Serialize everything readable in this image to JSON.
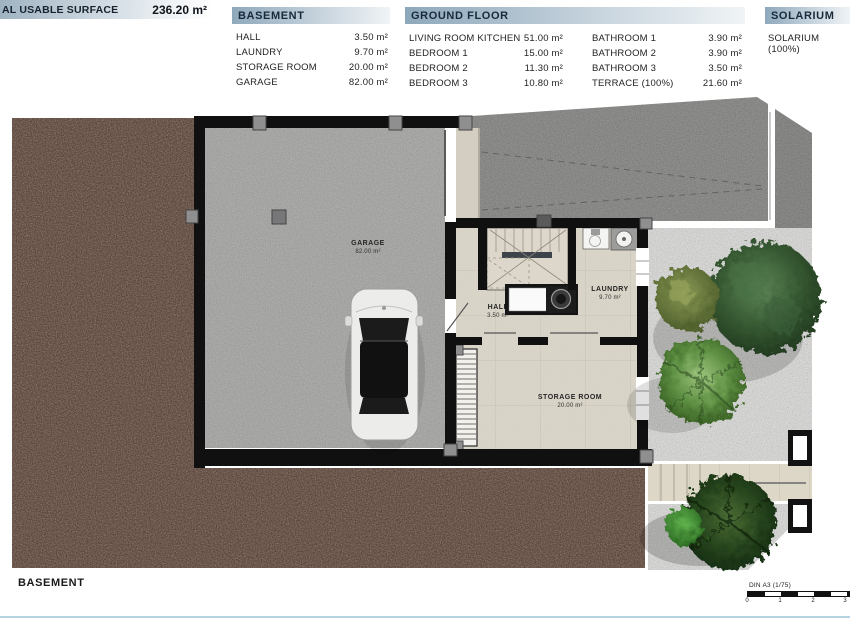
{
  "header": {
    "summary": {
      "title": "PE VILLA",
      "plot": {
        "label": "PLOT:",
        "value": "350.00 m²"
      },
      "built": {
        "label": "LT SURFACE",
        "sub": "(Terrace 100%)",
        "value": "249.90 m²"
      },
      "usable": {
        "label": "AL USABLE SURFACE",
        "value": "236.20 m²"
      }
    },
    "basement": {
      "title": "BASEMENT",
      "rows": [
        {
          "label": "HALL",
          "value": "3.50 m²"
        },
        {
          "label": "LAUNDRY",
          "value": "9.70 m²"
        },
        {
          "label": "STORAGE ROOM",
          "value": "20.00 m²"
        },
        {
          "label": "GARAGE",
          "value": "82.00 m²"
        }
      ]
    },
    "ground_floor": {
      "title": "GROUND FLOOR",
      "rows_left": [
        {
          "label": "LIVING ROOM KITCHEN",
          "value": "51.00 m²"
        },
        {
          "label": "BEDROOM 1",
          "value": "15.00 m²"
        },
        {
          "label": "BEDROOM 2",
          "value": "11.30 m²"
        },
        {
          "label": "BEDROOM 3",
          "value": "10.80 m²"
        }
      ],
      "rows_right": [
        {
          "label": "BATHROOM 1",
          "value": "3.90 m²"
        },
        {
          "label": "BATHROOM 2",
          "value": "3.90 m²"
        },
        {
          "label": "BATHROOM 3",
          "value": "3.50 m²"
        },
        {
          "label": "TERRACE (100%)",
          "value": "21.60 m²"
        }
      ]
    },
    "solarium": {
      "title": "SOLARIUM",
      "rows": [
        {
          "label": "SOLARIUM (100%)"
        }
      ]
    }
  },
  "plan": {
    "rooms": [
      {
        "name": "GARAGE",
        "area": "82.00 m²"
      },
      {
        "name": "HALL",
        "area": "3.50 m²"
      },
      {
        "name": "LAUNDRY",
        "area": "9.70 m²"
      },
      {
        "name": "STORAGE ROOM",
        "area": "20.00 m²"
      }
    ]
  },
  "footer": {
    "caption": "BASEMENT",
    "scale_label": "DIN A3 (1/75)",
    "scale_ticks": [
      "0",
      "1",
      "2",
      "3"
    ]
  },
  "colors": {
    "soil": "#6d5345",
    "garage_floor": "#a8a8a6",
    "driveway": "#8d8d8b",
    "gravel": "#d5d5d3",
    "tile": "#d7d2c5",
    "wall": "#101010",
    "header_band": "#9fb3c2",
    "footer_line": "#b7d3e2"
  }
}
